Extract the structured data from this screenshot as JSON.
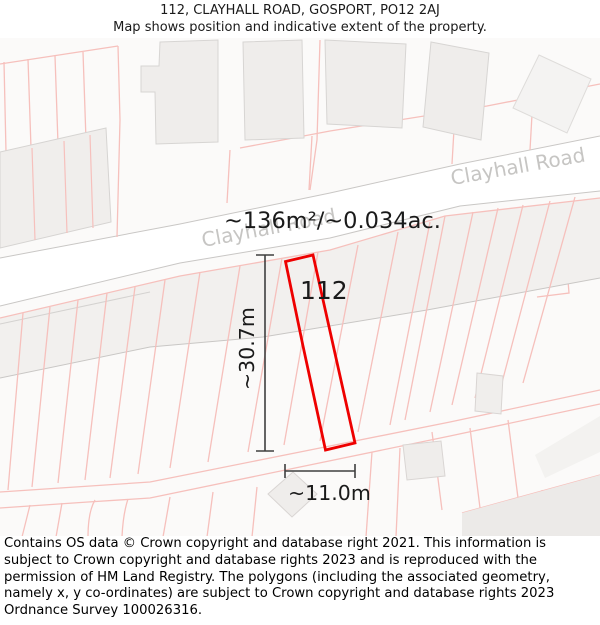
{
  "header": {
    "title": "112, CLAYHALL ROAD, GOSPORT, PO12 2AJ",
    "subtitle": "Map shows position and indicative extent of the property."
  },
  "map": {
    "road_name": "Clayhall Road",
    "area_label": "~136m²/~0.034ac.",
    "property": {
      "number": "112",
      "outline_color": "#ee0000"
    },
    "dimensions": {
      "height_label": "~30.7m",
      "width_label": "~11.0m"
    },
    "colors": {
      "parcel_line": "#f6c0bc",
      "road_edge": "#c9c7c5",
      "building_fill": "#efedeb",
      "road_label_gray": "#c6c5c3"
    }
  },
  "footer": {
    "copyright": "Contains OS data © Crown copyright and database right 2021. This information is subject to Crown copyright and database rights 2023 and is reproduced with the permission of HM Land Registry. The polygons (including the associated geometry, namely x, y co-ordinates) are subject to Crown copyright and database rights 2023 Ordnance Survey 100026316."
  }
}
